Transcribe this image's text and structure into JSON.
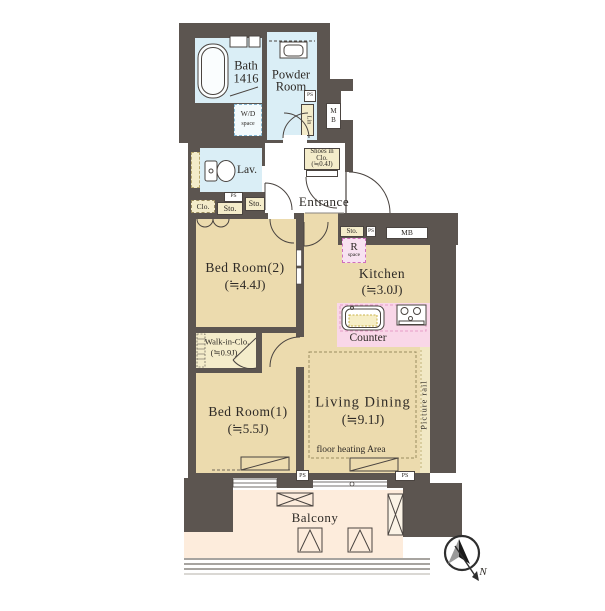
{
  "colors": {
    "wall": "#5c5550",
    "floor": "#ecdbae",
    "wet": "#daeef6",
    "storage": "#f4ecca",
    "counter": "#f9d7e8",
    "balcony": "#fdecdc",
    "rspace": "#f8e2f1",
    "rspace_border": "#cf6fbe",
    "counter_border": "#e79cc8",
    "wd_border": "#86b9d4",
    "line": "#4a4440",
    "text": "#2e2a26",
    "prail": "#f1e8c4"
  },
  "rooms": {
    "bath": {
      "line1": "Bath",
      "line2": "1416"
    },
    "powder": {
      "line1": "Powder",
      "line2": "Room"
    },
    "wd": {
      "line1": "W/D",
      "line2": "space"
    },
    "lin": {
      "label": "Lin"
    },
    "mb_shaft": {
      "line1": "M",
      "line2": "B"
    },
    "shoes": {
      "line1": "Shoes in",
      "line2": "Clo.",
      "line3": "(≒0.4J)"
    },
    "lav": {
      "label": "Lav."
    },
    "clo": {
      "label": "Clo."
    },
    "sto_hall_left": {
      "label": "Sto."
    },
    "sto_hall_right": {
      "label": "Sto."
    },
    "entrance": {
      "label": "Entrance"
    },
    "bed2": {
      "line1": "Bed Room(2)",
      "line2": "(≒4.4J)"
    },
    "sto_kitchen": {
      "label": "Sto."
    },
    "mb_kitchen": {
      "label": "MB"
    },
    "rspace": {
      "line1": "R",
      "line2": "space"
    },
    "kitchen": {
      "line1": "Kitchen",
      "line2": "(≒3.0J)"
    },
    "counter": {
      "label": "Counter"
    },
    "wic": {
      "line1": "Walk-in-Clo.",
      "line2": "(≒0.9J)"
    },
    "bed1": {
      "line1": "Bed Room(1)",
      "line2": "(≒5.5J)"
    },
    "living": {
      "line1": "Living Dining",
      "line2": "(≒9.1J)"
    },
    "floor_heating": {
      "label": "floor heating Area"
    },
    "picture_rail": {
      "label": "Picture rail"
    },
    "balcony": {
      "label": "Balcony"
    }
  },
  "ps": {
    "a": "PS",
    "b": "PS",
    "c": "PS",
    "d": "PS",
    "e": "PS"
  },
  "compass": {
    "north": "N"
  }
}
